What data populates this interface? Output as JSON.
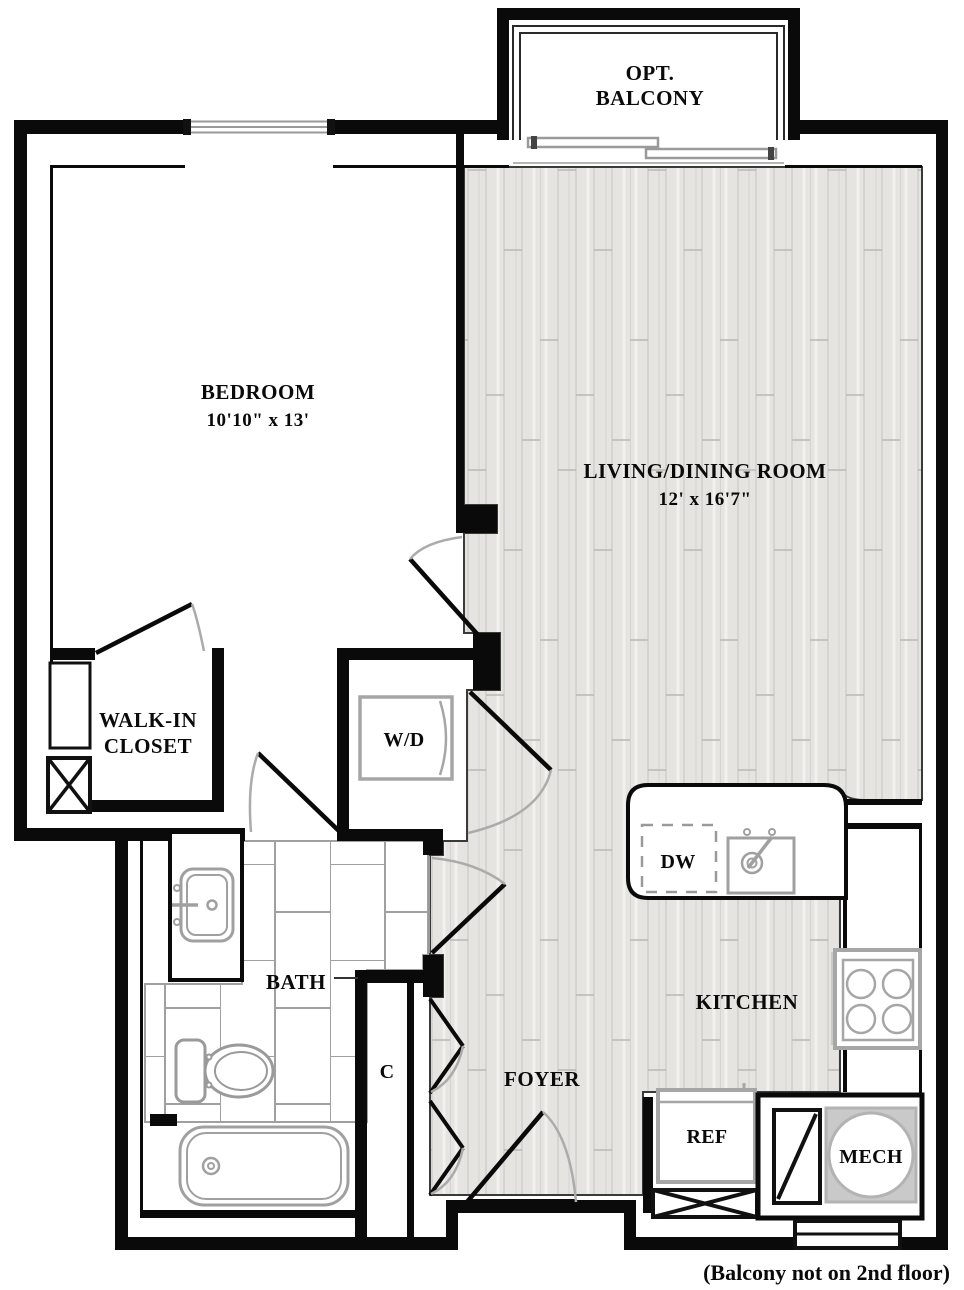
{
  "plan": {
    "balcony": {
      "line1": "OPT.",
      "line2": "BALCONY"
    },
    "bedroom": {
      "name": "BEDROOM",
      "dims": "10'10\" x 13'"
    },
    "living": {
      "name": "LIVING/DINING ROOM",
      "dims": "12' x 16'7\""
    },
    "walk_in_closet": {
      "line1": "WALK-IN",
      "line2": "CLOSET"
    },
    "washer_dryer": "W/D",
    "dishwasher": "DW",
    "bath": "BATH",
    "closet_c": "C",
    "foyer": "FOYER",
    "kitchen": "KITCHEN",
    "refrigerator": "REF",
    "mechanical": "MECH",
    "note": "(Balcony not on 2nd floor)"
  },
  "colors": {
    "wall": "#0a0a0a",
    "fixture_gray": "#a6a6a6",
    "wood_base": "#e5e4e1",
    "wood_stripe": "#cfcecb",
    "tile_line": "#a0a0a0",
    "mech_fill": "#c9c9c9"
  }
}
